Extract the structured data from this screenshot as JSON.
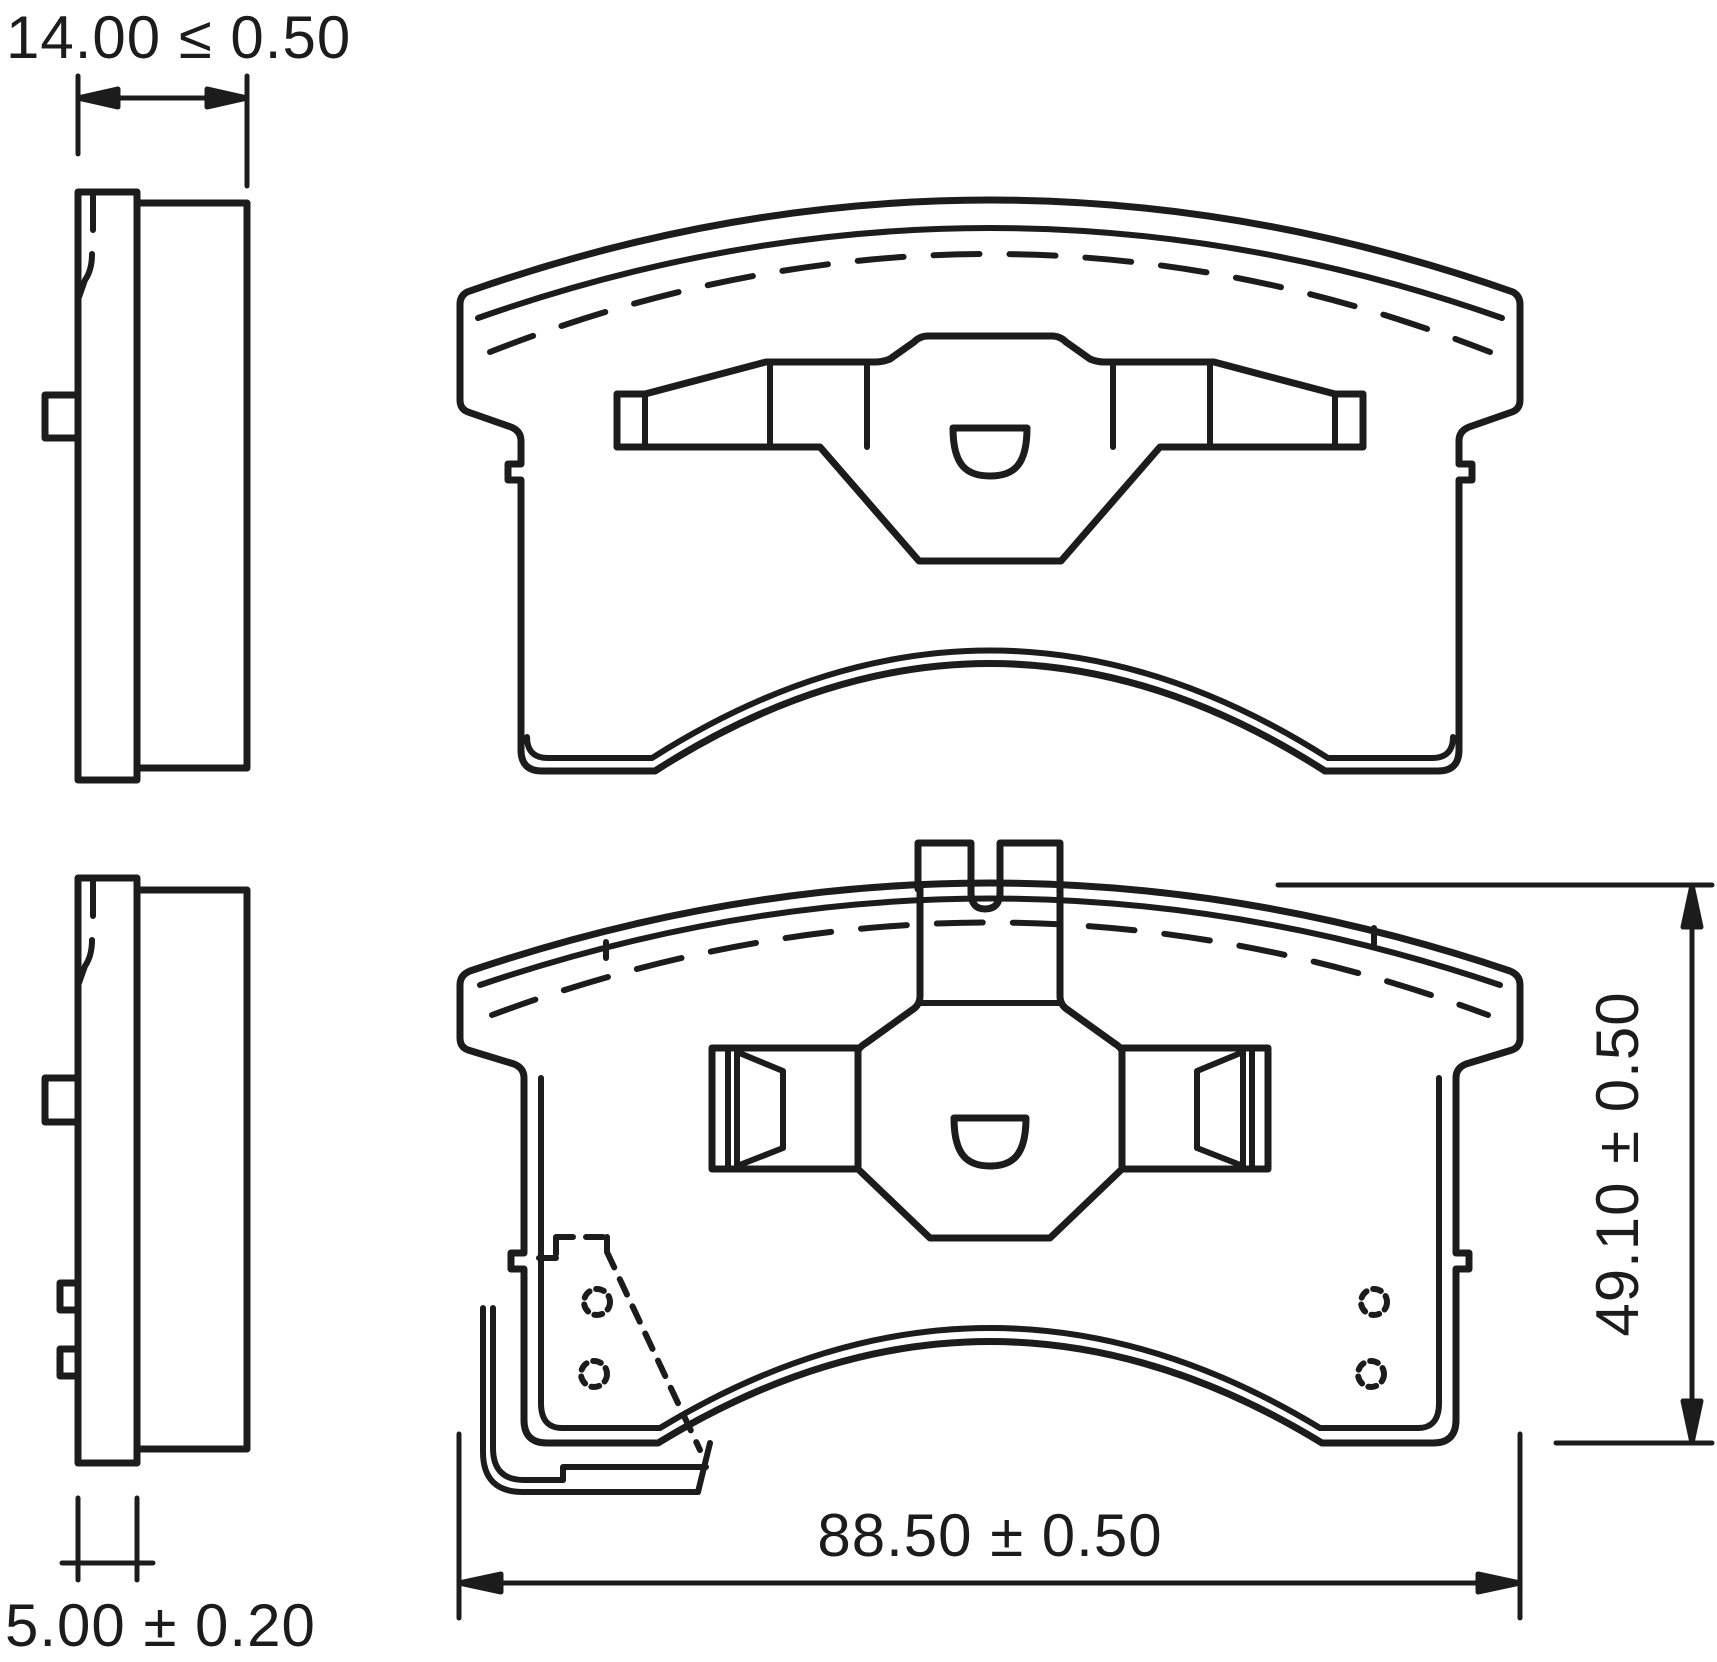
{
  "dimensions": {
    "pad_thickness": "14.00 ≤ 0.50",
    "backplate_thickness": "5.00 ± 0.20",
    "pad_width": "88.50 ± 0.50",
    "pad_height": "49.10 ± 0.50"
  },
  "colors": {
    "line": "#1c1c1c",
    "background": "#ffffff"
  }
}
